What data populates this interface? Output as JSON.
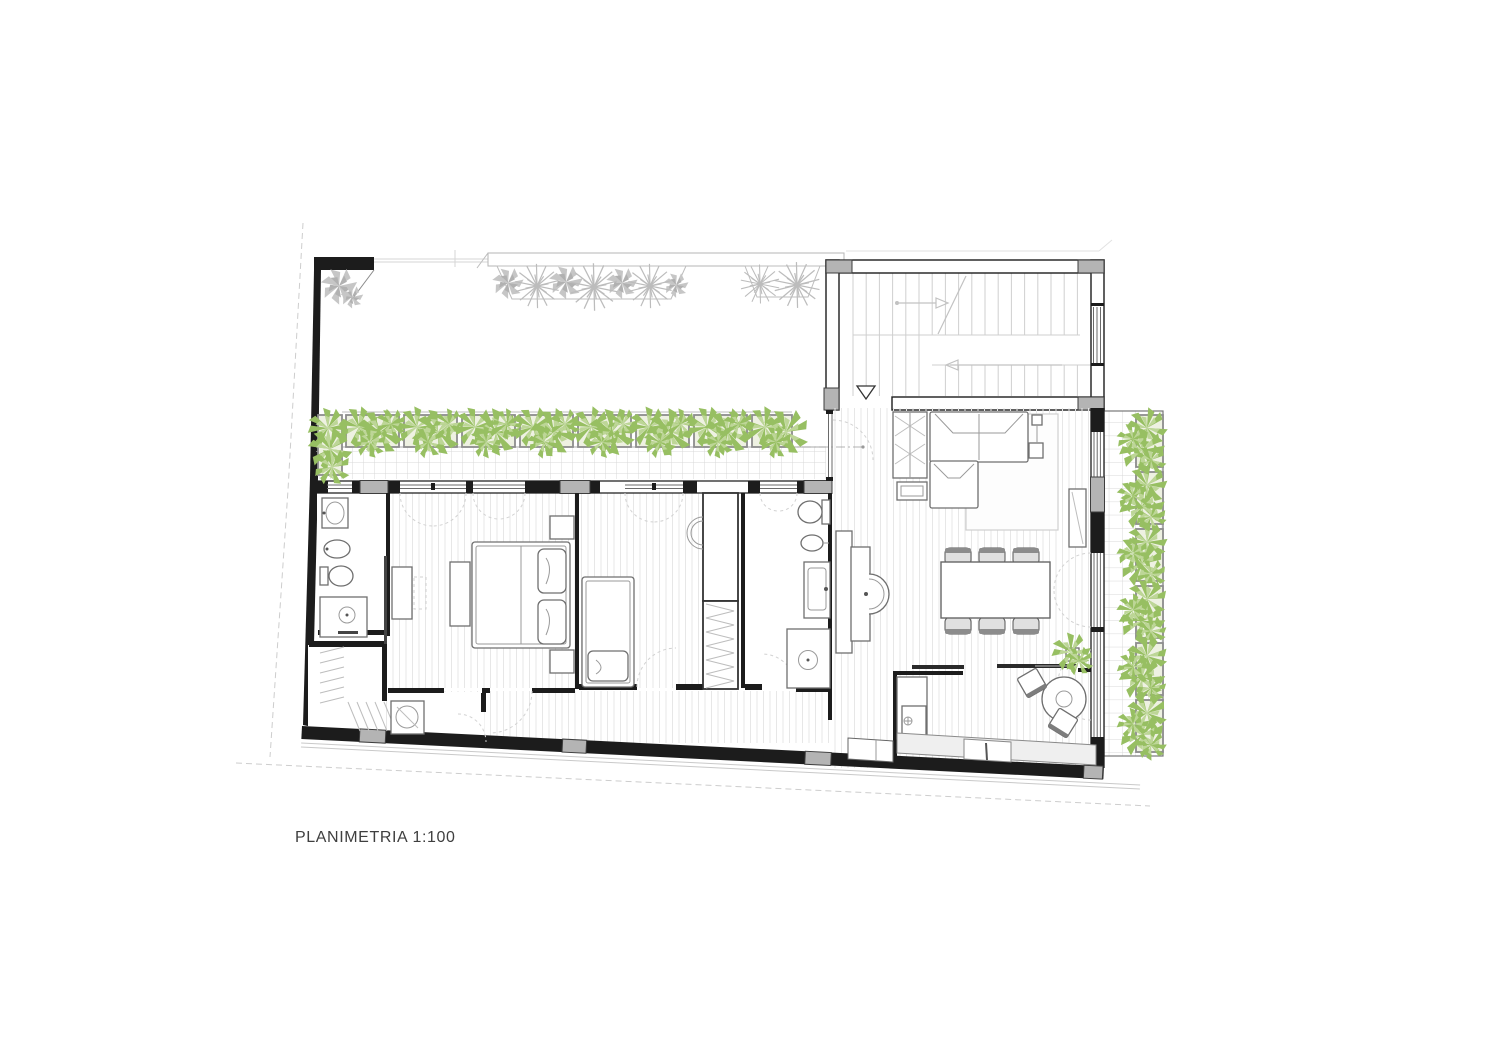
{
  "plan": {
    "label": "PLANIMETRIA 1:100",
    "colors": {
      "wall": "#1c1c1c",
      "pier": "#b4b4b4",
      "glass": "#6a6a6a",
      "tile": "#d8d8d8",
      "wood": "#e7e7e7",
      "furniture": "#6f6f6f",
      "dash": "#d2d2d2",
      "plant_green": "#97bf62",
      "plant_green_light": "#bdd697",
      "plant_gray": "#bcbcbc",
      "planter_fill": "#eef1e2",
      "planter_stroke": "#8d8d8d",
      "label_text": "#3f3f3f"
    }
  }
}
